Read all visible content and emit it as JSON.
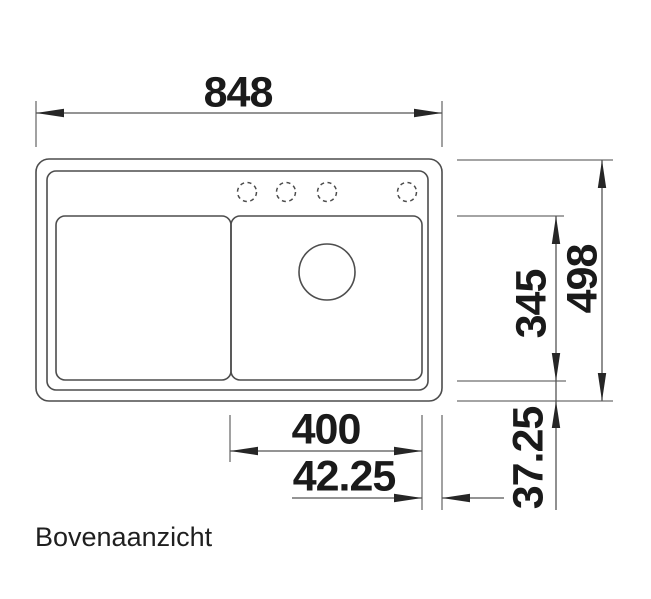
{
  "page": {
    "background": "#ffffff",
    "view_label": "Bovenaanzicht"
  },
  "drawing": {
    "type": "sink-top-view-technical-drawing",
    "line_color": "#4d4d4d",
    "extension_line_color": "#6e6e6e",
    "arrow_color": "#262626",
    "text_color": "#1a1a1a",
    "features": {
      "tap_holes": 4,
      "basins": 2,
      "drain_circles": 1
    },
    "dimensions": {
      "overall_width": "848",
      "overall_depth": "498",
      "basin_depth": "345",
      "basin_width": "400",
      "right_edge_offset": "42.25",
      "bottom_edge_offset": "37.25"
    }
  }
}
